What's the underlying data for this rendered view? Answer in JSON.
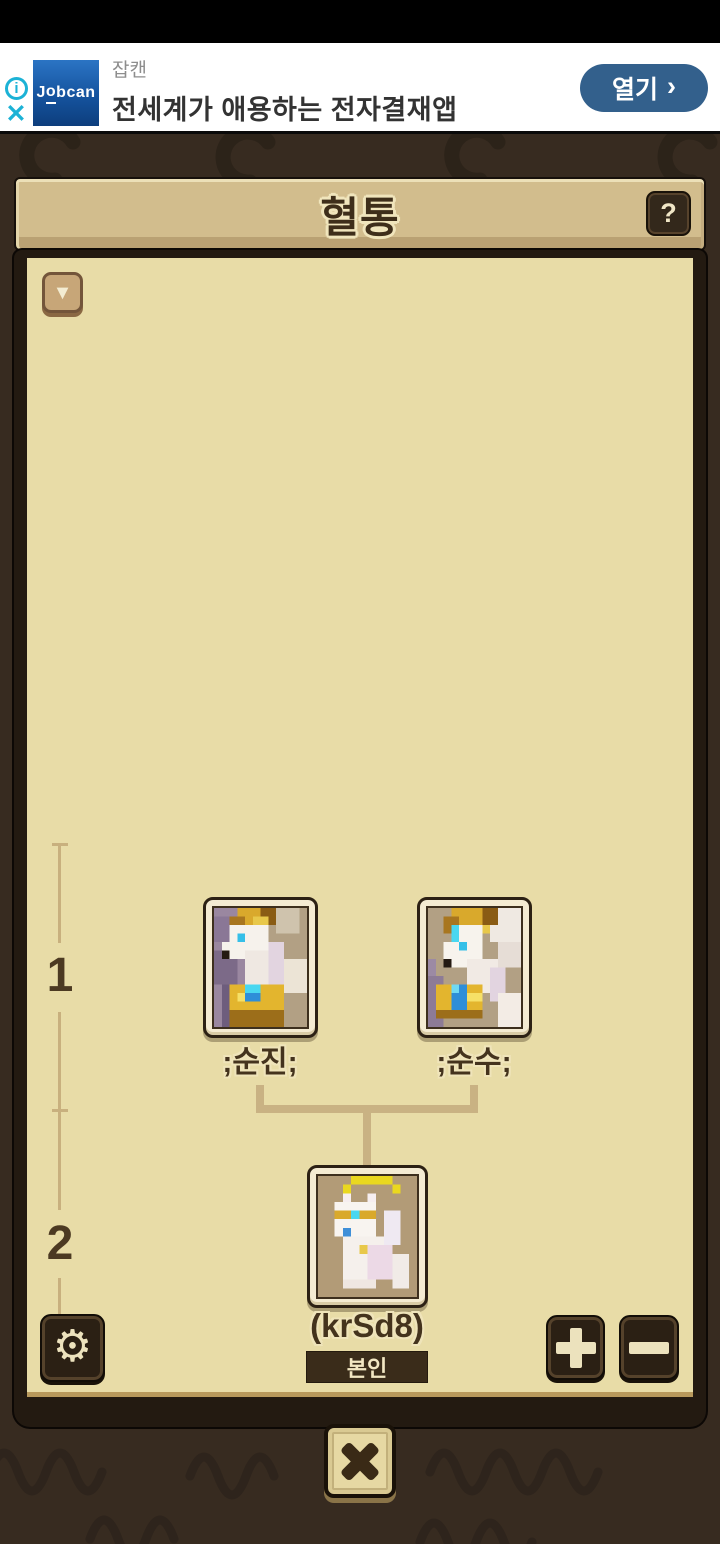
{
  "ad_banner": {
    "advertiser": "잡캔",
    "headline": "전세계가 애용하는 전자결재앱",
    "cta_label": "열기",
    "cta_chevron": "›",
    "logo": {
      "j": "J",
      "o": "o",
      "rest": "bcan"
    },
    "info_icon": "i",
    "close_icon": "✕",
    "colors": {
      "accent_cyan": "#1cb2d6",
      "cta_bg": "#33608c",
      "logo_blue_top": "#2b74c4",
      "logo_blue_bottom": "#0d3e7d",
      "headline_text": "#333333",
      "advertiser_text": "#8d8d8d"
    }
  },
  "pedigree": {
    "title": "혈통",
    "help_icon": "?",
    "collapse_icon": "▼",
    "generations": [
      {
        "label": "1",
        "members": [
          {
            "name": ";순진;",
            "portrait": "white-unicorn-gold-armor-purple-bg"
          },
          {
            "name": ";순수;",
            "portrait": "white-unicorn-gold-armor-tan-bg"
          }
        ]
      },
      {
        "label": "2",
        "members": [
          {
            "name": "(krSd8)",
            "badge": "본인",
            "portrait": "white-cat-gold-crown-halo"
          }
        ]
      }
    ],
    "controls": {
      "settings_icon": "⚙",
      "zoom_in_icon": "+",
      "zoom_out_icon": "−",
      "close_icon": "✕"
    },
    "colors": {
      "background_dark": "#372b20",
      "panel_cream": "#e8dca7",
      "header_tan": "#d2bd8d",
      "text_brown": "#46341e",
      "connector_tan": "#c9b283",
      "button_dark": "#2b2014",
      "glyph_cream": "#ece2bd"
    }
  }
}
